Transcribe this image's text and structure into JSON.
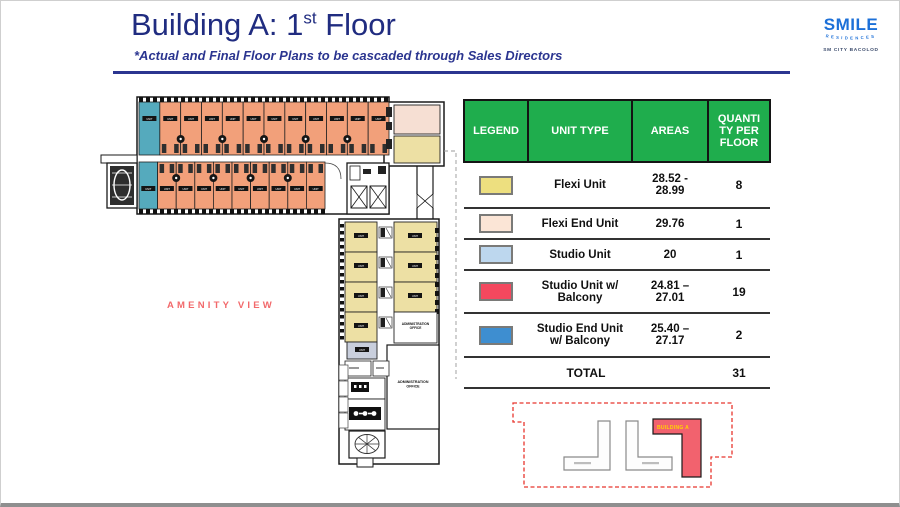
{
  "header": {
    "title_prefix": "Building A: 1",
    "title_superscript": "st",
    "title_suffix": " Floor",
    "subtitle": "*Actual and Final Floor Plans to be cascaded through Sales Directors"
  },
  "logo": {
    "brand": "SMILE",
    "brand_sub": "RESIDENCES",
    "location": "SM CITY BACOLOD"
  },
  "legend_table": {
    "headers": [
      "LEGEND",
      "UNIT TYPE",
      "AREAS",
      "QUANTI\nTY PER\nFLOOR"
    ],
    "rows": [
      {
        "swatch_color": "#EDDF7F",
        "unit_type": "Flexi Unit",
        "areas": "28.52 -\n28.99",
        "quantity": "8"
      },
      {
        "swatch_color": "#FBE5D6",
        "unit_type": "Flexi End Unit",
        "areas": "29.76",
        "quantity": "1"
      },
      {
        "swatch_color": "#BDD7EE",
        "unit_type": "Studio Unit",
        "areas": "20",
        "quantity": "1"
      },
      {
        "swatch_color": "#F4485E",
        "unit_type": "Studio Unit w/\nBalcony",
        "areas": "24.81 –\n27.01",
        "quantity": "19"
      },
      {
        "swatch_color": "#3E8ED0",
        "unit_type": "Studio End Unit\nw/ Balcony",
        "areas": "25.40 –\n27.17",
        "quantity": "2"
      }
    ],
    "total_label": "TOTAL",
    "total_value": "31"
  },
  "floor_plan": {
    "amenity_view_label": "AMENITY VIEW",
    "admin_office_label": "ADMINISTRATION OFFICE",
    "unit_label": "UNIT",
    "counts": {
      "top_row_units": 12,
      "bottom_row_units": 10,
      "wing_left_units": 4,
      "wing_right_units": 3
    }
  },
  "site_map": {
    "building_a_label": "BUILDING A"
  },
  "colors": {
    "accent_green": "#1FAD4D",
    "title_navy": "#202C80",
    "amenity_red": "#F2696B",
    "logo_blue": "#1C70D8",
    "plan_studio_balcony": "#F2A07A",
    "plan_studio_end_balcony": "#55AABD",
    "plan_flexi": "#EDE0A4",
    "plan_flexi_end": "#F6DFD3",
    "plan_studio": "#BDD7EE",
    "plan_service_unit": "#C9CFDD",
    "map_building_red": "#F2626E",
    "map_label_yellow": "#FFD400"
  }
}
